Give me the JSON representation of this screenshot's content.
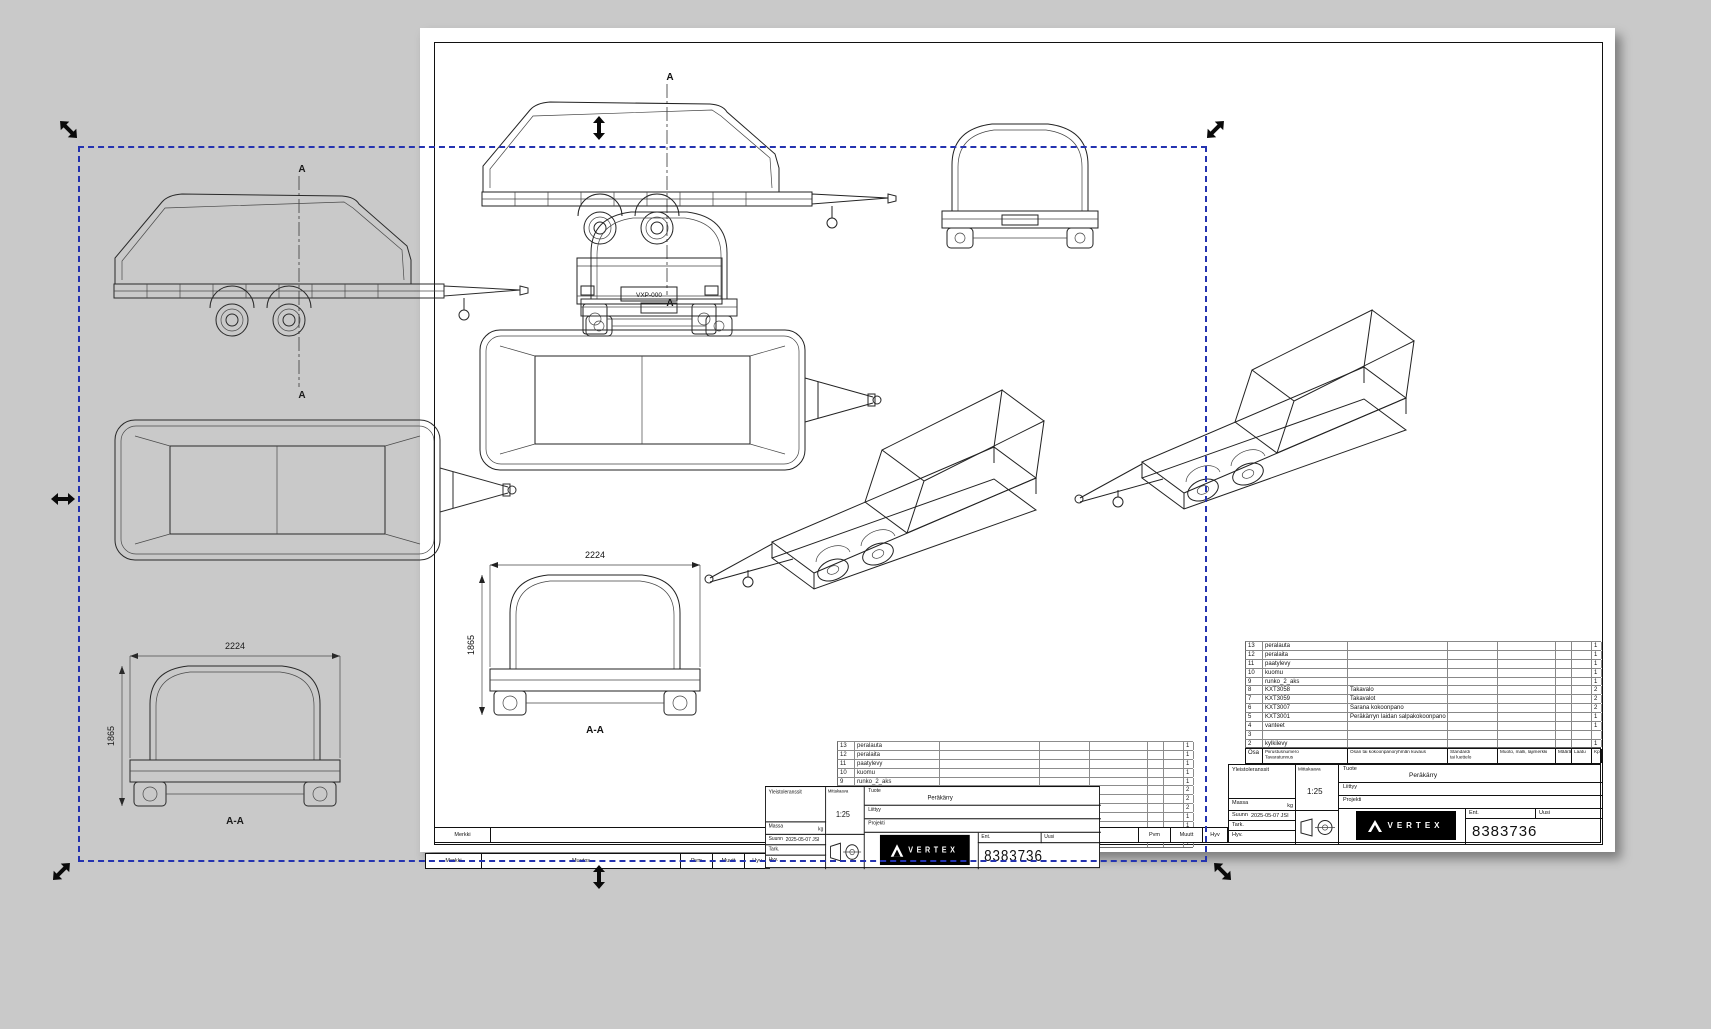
{
  "app": {
    "background": "#c9c9c9",
    "selection_color": "#2433b0"
  },
  "drawing": {
    "section_label": "A",
    "plate": "VXP-000",
    "dims": {
      "width": "2224",
      "height": "1865",
      "section": "A-A"
    }
  },
  "parts": {
    "headers": {
      "osa": "Osa",
      "piirustusnumero": "Piirustusnumero",
      "tavaratunnus": "Tavaratunnus",
      "kuvaus": "Osan tai kokoonpanoryhmän kuvaus",
      "standardi": "Standardi",
      "luettelo": "tai luettelo",
      "muoto": "Muoto, malli, lajimerkki",
      "maara": "Määrä",
      "laatu": "Laatu",
      "kpl": "Kpl"
    },
    "rows": [
      {
        "no": "13",
        "name": "peralauta",
        "desc": "",
        "qty": "1"
      },
      {
        "no": "12",
        "name": "peralaita",
        "desc": "",
        "qty": "1"
      },
      {
        "no": "11",
        "name": "paatylevy",
        "desc": "",
        "qty": "1"
      },
      {
        "no": "10",
        "name": "kuomu",
        "desc": "",
        "qty": "1"
      },
      {
        "no": "9",
        "name": "runko_2_aks",
        "desc": "",
        "qty": "1"
      },
      {
        "no": "8",
        "name": "KXT3058",
        "desc": "Takavalo",
        "qty": "2"
      },
      {
        "no": "7",
        "name": "KXT3059",
        "desc": "Takavalot",
        "qty": "2"
      },
      {
        "no": "6",
        "name": "KXT3007",
        "desc": "Sarana kokoonpano",
        "qty": "2"
      },
      {
        "no": "5",
        "name": "KXT3001",
        "desc": "Peräkärryn laidan salpakokoonpano",
        "qty": "1"
      },
      {
        "no": "4",
        "name": "vanteet",
        "desc": "",
        "qty": "1"
      },
      {
        "no": "3",
        "name": "",
        "desc": "",
        "qty": ""
      },
      {
        "no": "2",
        "name": "kylkilevy",
        "desc": "",
        "qty": "1"
      }
    ]
  },
  "titleblock": {
    "yleistoleranssit": "Yleistoleranssit",
    "massa": "Massa",
    "kg": "kg",
    "mittakaava": "Mittakaava",
    "scale": "1:25",
    "tuote": "Tuote",
    "product": "Peräkärry",
    "liittyy": "Liittyy",
    "projekti": "Projekti",
    "suunn": "Suunn",
    "date": "2025-05-07 JSI",
    "tark": "Tark.",
    "hyv": "Hyv.",
    "ent": "Ent.",
    "uusi": "Uusi",
    "number": "8383736",
    "brand": "VERTEX"
  },
  "revision": {
    "merkki": "Merkki",
    "muutos": "Muutos",
    "pvm": "Pvm",
    "muutt": "Muutt",
    "hyv": "Hyv"
  }
}
